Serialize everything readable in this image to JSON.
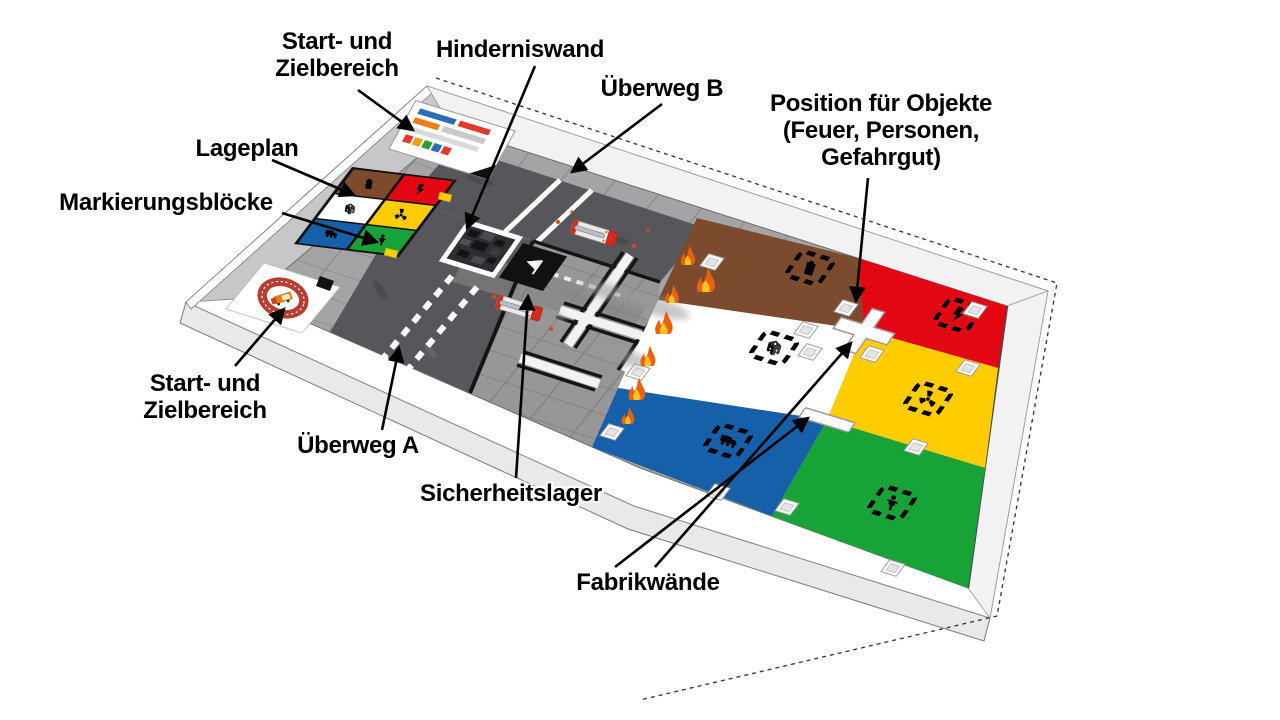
{
  "labels": {
    "start_ziel_top": {
      "lines": [
        "Start- und",
        "Zielbereich"
      ]
    },
    "hinderniswand": {
      "text": "Hinderniswand"
    },
    "ueberweg_b": {
      "text": "Überweg B"
    },
    "position_objekte": {
      "lines": [
        "Position für Objekte",
        "(Feuer, Personen,",
        "Gefahrgut)"
      ]
    },
    "lageplan": {
      "text": "Lageplan"
    },
    "markierungsbloecke": {
      "text": "Markierungsblöcke"
    },
    "start_ziel_bottom": {
      "lines": [
        "Start- und",
        "Zielbereich"
      ]
    },
    "ueberweg_a": {
      "text": "Überweg A"
    },
    "sicherheitslager": {
      "text": "Sicherheitslager"
    },
    "fabrikwaende": {
      "text": "Fabrikwände"
    }
  },
  "zones": [
    {
      "name": "brown",
      "color": "#7c4b2e",
      "icon": "gas-canister-icon"
    },
    {
      "name": "red",
      "color": "#e30613",
      "icon": "zigzag-arrow-icon"
    },
    {
      "name": "white",
      "color": "#ffffff",
      "icon": "dice-icon"
    },
    {
      "name": "yellow",
      "color": "#ffcc00",
      "icon": "radiation-icon"
    },
    {
      "name": "blue",
      "color": "#1560a8",
      "icon": "truck-icon"
    },
    {
      "name": "green",
      "color": "#17a338",
      "icon": "person-icon"
    }
  ],
  "marker_blocks": [
    {
      "name": "brown",
      "color": "#7c4b2e",
      "icon": "gas-canister-icon"
    },
    {
      "name": "red",
      "color": "#e30613",
      "icon": "zigzag-arrow-icon"
    },
    {
      "name": "white",
      "color": "#ffffff",
      "icon": "dice-icon"
    },
    {
      "name": "yellow",
      "color": "#ffcc00",
      "icon": "radiation-icon"
    },
    {
      "name": "blue",
      "color": "#1560a8",
      "icon": "truck-icon"
    },
    {
      "name": "green",
      "color": "#17a338",
      "icon": "person-icon"
    }
  ],
  "board": {
    "road_color": "#57575b",
    "tile_color": "#a4a4a6",
    "frame_color": "#ffffff",
    "wall_face_color": "#c7c7c9",
    "flame_outer_color": "#e8610e",
    "flame_inner_color": "#ffc423",
    "emblem_ring_color": "#b93c30",
    "sicherheitslager_icon": "warning-flag-icon",
    "hinderniswand_texture": "rubble-blocks",
    "fire_truck_icon": "fire-truck-top-view"
  }
}
